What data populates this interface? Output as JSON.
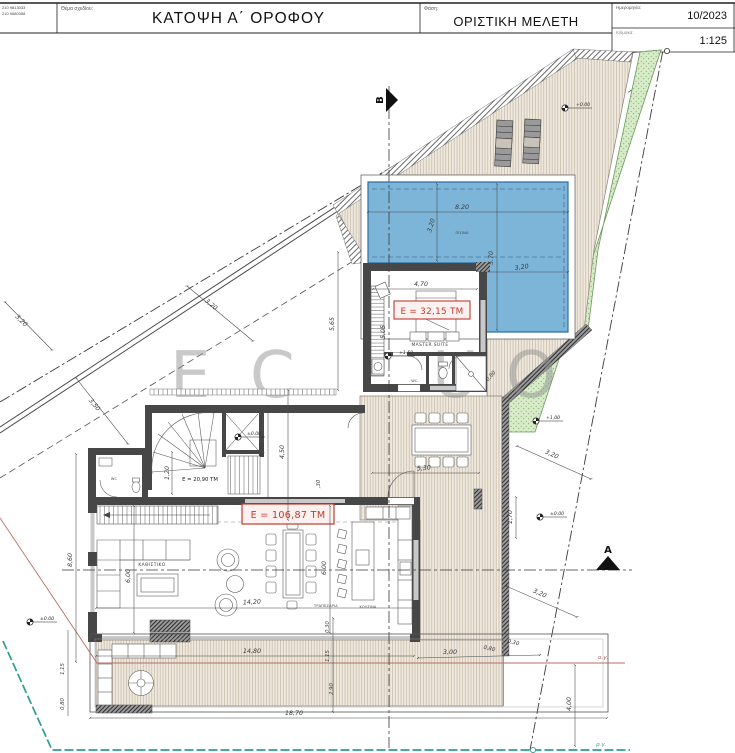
{
  "title_block": {
    "contact_line1": "210 9813033",
    "contact_line2": "210 9680358",
    "subject_label": "Θέμα σχεδίου:",
    "subject": "ΚΑΤΟΨΗ Α΄ ΟΡΟΦΟΥ",
    "phase_label": "Φάση:",
    "phase": "ΟΡΙΣΤΙΚΗ ΜΕΛΕΤΗ",
    "date_label": "Ημερομηνία:",
    "date": "10/2023",
    "scale_label": "Κλίμακα:",
    "scale": "1:125"
  },
  "watermark": {
    "l1": "E",
    "l2": "C",
    "l3": "U",
    "l4": "O"
  },
  "rooms": {
    "pool": "ΠΙΣΙΝΑ",
    "master": "MASTER SUITE",
    "master_wc": "WC.",
    "lift": "LIFT",
    "wc": "WC",
    "living": "ΚΑΘΙΣΤΙΚΟ",
    "dining": "ΤΡΑΠΕΖΑΡΙΑ",
    "kitchen": "ΚΟΥΖΙΝΑ"
  },
  "areas": {
    "master": "E = 32,15 TM",
    "landing": "E = 20,90 TM",
    "living": "E = 106,87 TM"
  },
  "dims": {
    "pool_width": "8.20",
    "pool_depth": "3.20",
    "pool_length": "5.70",
    "pool_leg": "3,20",
    "master_width": "4,70",
    "master_height": "5,05",
    "master_side": "0,80",
    "fence_a": "3,20",
    "fence_b": "3,50",
    "fence_c": "3,20",
    "deck_height": "5,65",
    "landing_a": "1,20",
    "landing_b": "3,70",
    "landing_c": "4,50",
    "landing_d": ",30",
    "terrace_dining": "5,30",
    "right_a": "3,20",
    "right_b": "1,70",
    "right_c": "3,20",
    "living_width": "14,20",
    "living_height": "6,00",
    "kitchen_height": "6,00",
    "west_height": "8,60",
    "balcony_width": "14,80",
    "slab_width": "18,70",
    "bl_a": "1,15",
    "bl_b": "0,80",
    "bm_a": "0,30",
    "bm_b": "1,15",
    "bm_c": "2,90",
    "br_a": "3,00",
    "br_b": "0,80",
    "br_c": "0,30",
    "east_height": "4,00"
  },
  "levels": {
    "deck_top": "+0.00",
    "upper_deck": "+1.50",
    "landing": "±0.00",
    "west": "±0.00",
    "east": "±0.00",
    "garden": "+1,00"
  },
  "sections": {
    "a": "A",
    "b": "B"
  },
  "boundary_labels": {
    "building_line": "ο.γ.",
    "street_line": "ρ.γ."
  },
  "colors": {
    "pool": "#7db5d8",
    "deck": "#efe9de",
    "garden": "#d9ecca",
    "area_label": "#c13b30",
    "building_line": "#b4705f",
    "street_line": "#2f9e8f"
  }
}
